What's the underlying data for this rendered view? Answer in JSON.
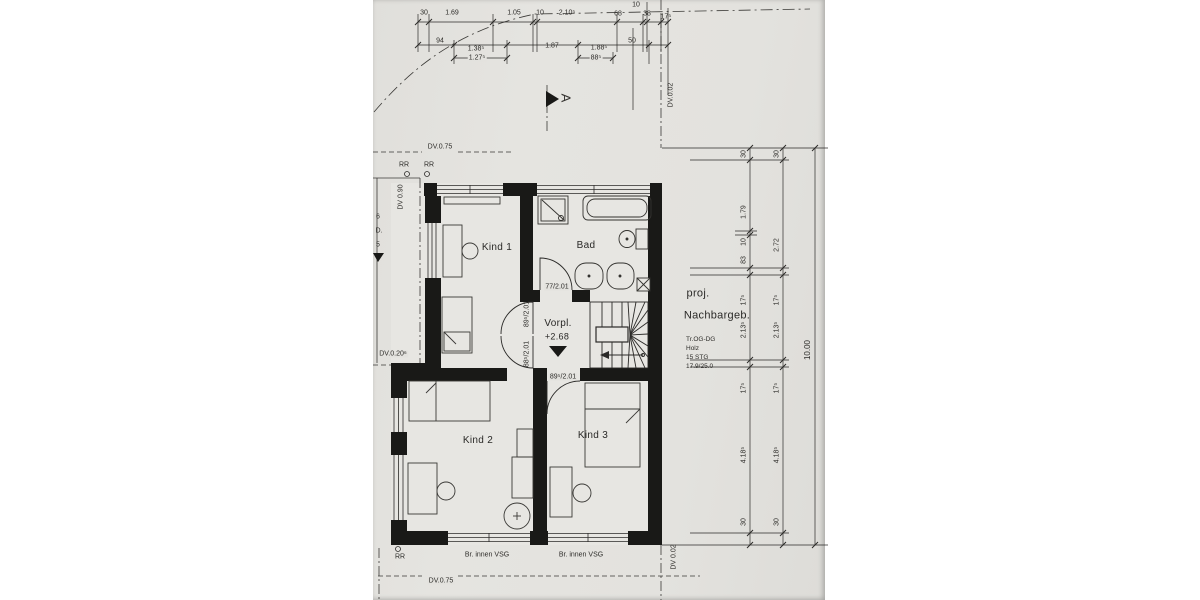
{
  "rooms": {
    "kind1": "Kind 1",
    "bad": "Bad",
    "vorplatz": "Vorpl.",
    "vorplatz_level": "+2.68",
    "kind2": "Kind 2",
    "kind3": "Kind 3"
  },
  "neighbor": {
    "line1": "proj.",
    "line2": "Nachbargeb."
  },
  "stair_note": {
    "line1": "Tr.OG-DG",
    "line2": "Holz",
    "line3": "15 STG",
    "line4": "17.9/25.0"
  },
  "doors": {
    "bad": "77/2.01",
    "kind1": "89⁵/2.01",
    "kind2": "88⁵/2.01",
    "kind3": "89⁵/2.01"
  },
  "annotations": {
    "dv_top": "DV.0.75",
    "dv_left_vertical": "DV 0.90",
    "dv_left_mid": "DV.0.20⁶",
    "dv_bottom": "DV.0.75",
    "dv_right_top": "DV.0.02",
    "dv_right_bottom": "DV 0.02",
    "rr_top_left": "RR",
    "rr_top_right": "RR",
    "rr_bottom": "RR",
    "glass_left": "Br. innen VSG",
    "glass_right": "Br. innen VSG",
    "section_marker": "A",
    "edge_fragment1": "6",
    "edge_fragment2": "D.",
    "edge_fragment3": "5"
  },
  "dims": {
    "top1": [
      "30",
      "1.69",
      "1.05",
      "10",
      "2.10⁵",
      "68",
      "10",
      "38",
      "17⁵"
    ],
    "top2": [
      "94",
      "1.38⁵",
      "1.87",
      "1.88⁵",
      "50"
    ],
    "top3": [
      "1.27⁵",
      "88⁵"
    ],
    "right_inner": [
      "30",
      "1.79",
      "10",
      "83",
      "17⁵",
      "2.13⁵",
      "17⁵",
      "4.18⁵",
      "30"
    ],
    "right_outer": [
      "30",
      "2.72",
      "17⁵",
      "2.13⁵",
      "17⁵",
      "4.18⁵",
      "30"
    ],
    "right_total": "10.00"
  },
  "colors": {
    "paper": "#e3e2de",
    "ink": "#2b2a28",
    "wall": "#191917"
  }
}
